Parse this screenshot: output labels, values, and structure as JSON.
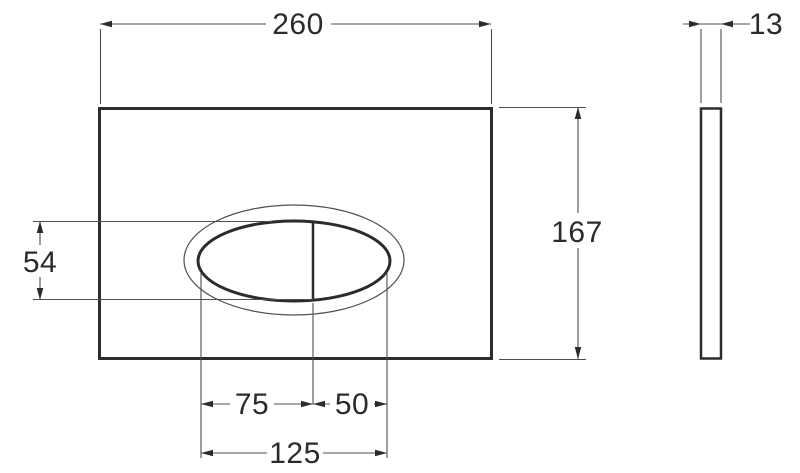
{
  "drawing": {
    "title": "flush-plate dimension drawing",
    "views": {
      "front": {
        "name": "front view with oval dual-flush button"
      },
      "side": {
        "name": "side profile view"
      }
    },
    "colors": {
      "background": "#ffffff",
      "outline": "#2c2c2c",
      "dimension_line": "#4f4f4f",
      "text": "#2b2b2b"
    },
    "dimensions": {
      "plate_width": "260",
      "plate_thickness": "13",
      "plate_height": "167",
      "button_height": "54",
      "button_left_width": "75",
      "button_right_width": "50",
      "button_total_width": "125"
    }
  }
}
